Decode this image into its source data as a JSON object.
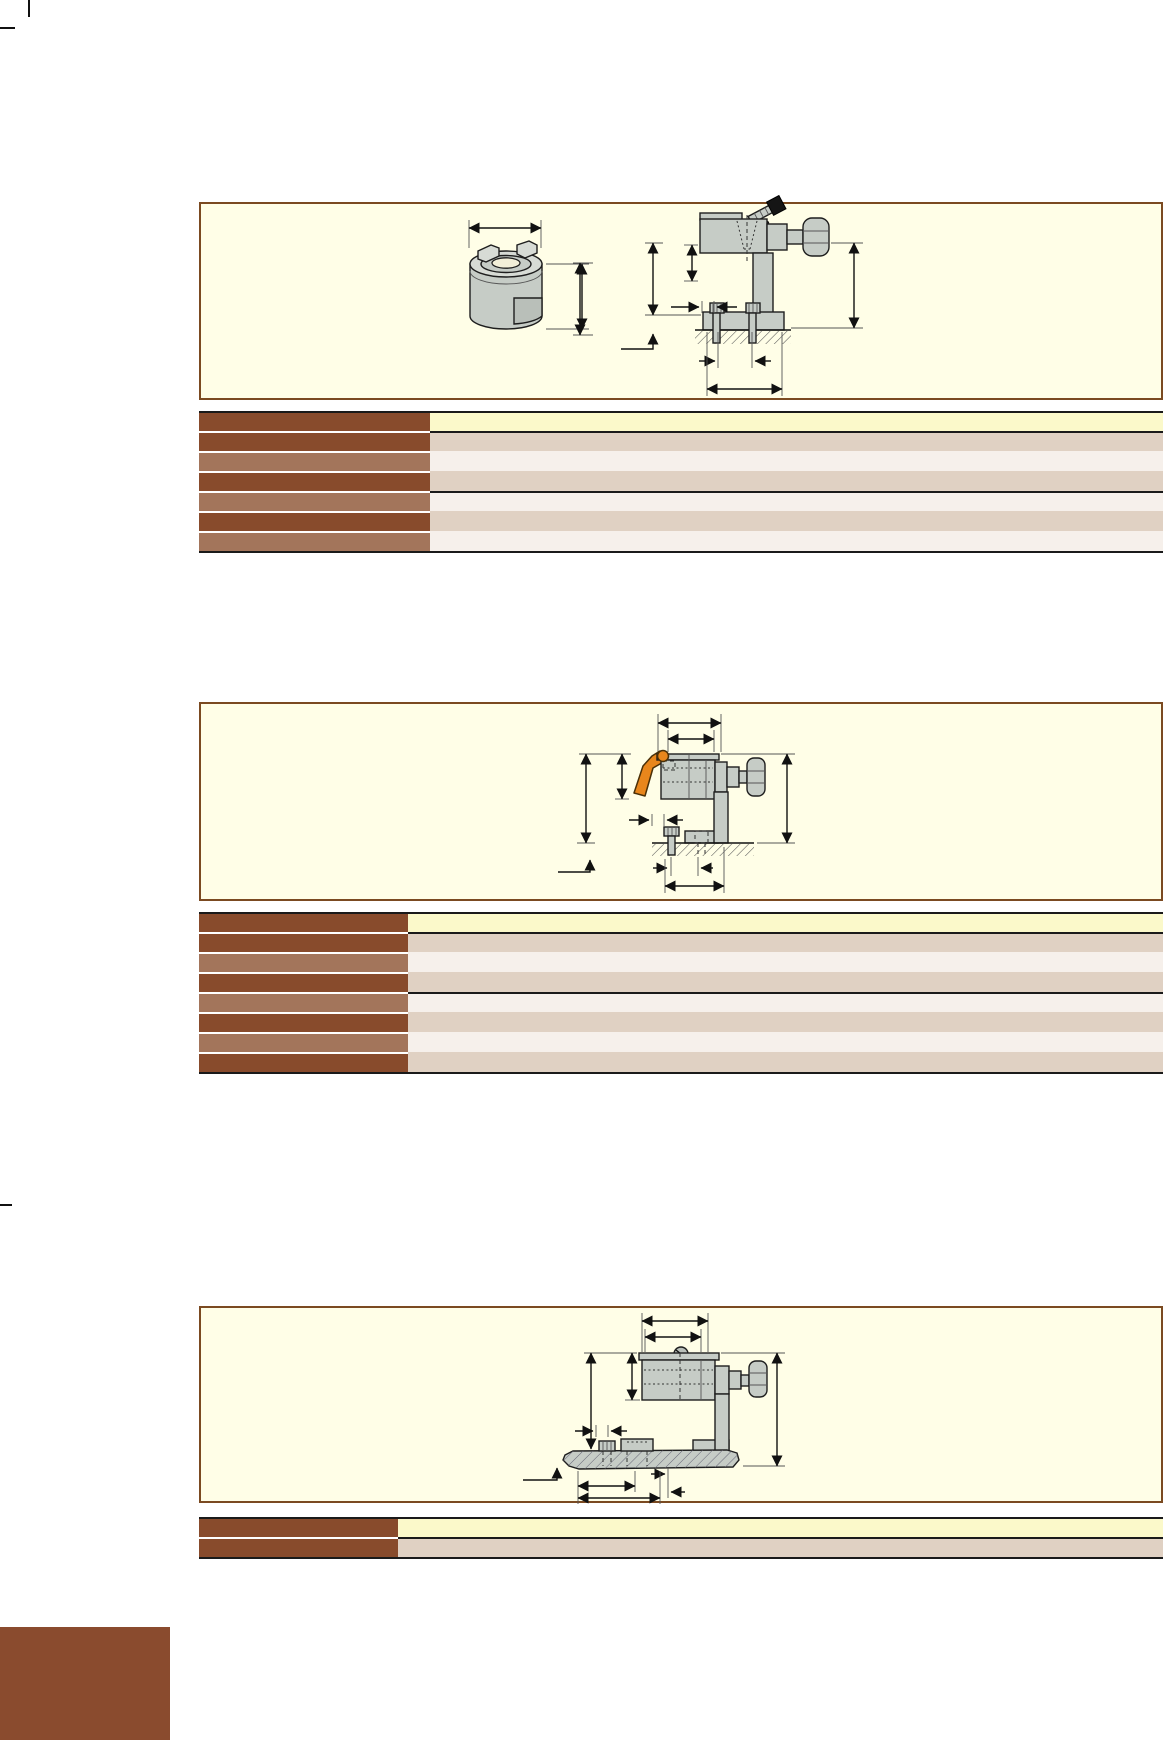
{
  "page": {
    "width": 1165,
    "height": 1740,
    "background": "#ffffff"
  },
  "colors": {
    "panel_fill": "#FFFEE7",
    "panel_border": "#7B4A21",
    "row_left_dark": "#884B2C",
    "row_left_medium": "#A3755B",
    "row_right_yellow": "#FBF9CA",
    "row_right_tan": "#E0D1C3",
    "row_right_light": "#F6F0EB",
    "table_line": "#1a1a1a",
    "accent_orange": "#E8861C",
    "part_gray": "#C6CCC6",
    "part_gray_light": "#D7DBD5",
    "part_gray_dark": "#B9BFB9",
    "footer_block_brown": "#8A4B2E"
  },
  "crop_marks": [
    {
      "x": 28,
      "y": 0,
      "w": 2,
      "h": 17
    },
    {
      "x": 0,
      "y": 27,
      "w": 15,
      "h": 2
    },
    {
      "x": 0,
      "y": 1204,
      "w": 12,
      "h": 2
    },
    {
      "x": 0,
      "y": 1711,
      "w": 15,
      "h": 2
    },
    {
      "x": 27,
      "y": 1721,
      "w": 2,
      "h": 19
    }
  ],
  "sections": [
    {
      "name": "product-block-1",
      "drawings": [
        "drive-dog-isometric-drawing",
        "clamp-stop-side-view-drawing"
      ],
      "table": {
        "left": 199,
        "top": 411,
        "width": 964,
        "header_col_width": 231,
        "rows": [
          {
            "kind": "header",
            "left_shade": "dark",
            "right_shade": "yellow",
            "separator_after": "black"
          },
          {
            "kind": "data",
            "left_shade": "dark",
            "right_shade": "tan",
            "separator_after": "none"
          },
          {
            "kind": "data",
            "left_shade": "medium",
            "right_shade": "light",
            "separator_after": "none"
          },
          {
            "kind": "data",
            "left_shade": "dark",
            "right_shade": "tan",
            "separator_after": "black"
          },
          {
            "kind": "data",
            "left_shade": "medium",
            "right_shade": "light",
            "separator_after": "none"
          },
          {
            "kind": "data",
            "left_shade": "dark",
            "right_shade": "tan",
            "separator_after": "none"
          },
          {
            "kind": "data",
            "left_shade": "medium",
            "right_shade": "light",
            "separator_after": "none"
          }
        ]
      }
    },
    {
      "name": "product-block-2",
      "drawings": [
        "lever-clamp-side-view-drawing"
      ],
      "table": {
        "left": 199,
        "top": 912,
        "width": 964,
        "header_col_width": 209,
        "rows": [
          {
            "kind": "header",
            "left_shade": "dark",
            "right_shade": "yellow",
            "separator_after": "black"
          },
          {
            "kind": "data",
            "left_shade": "dark",
            "right_shade": "tan",
            "separator_after": "none"
          },
          {
            "kind": "data",
            "left_shade": "medium",
            "right_shade": "light",
            "separator_after": "none"
          },
          {
            "kind": "data",
            "left_shade": "dark",
            "right_shade": "tan",
            "separator_after": "black"
          },
          {
            "kind": "data",
            "left_shade": "medium",
            "right_shade": "light",
            "separator_after": "none"
          },
          {
            "kind": "data",
            "left_shade": "dark",
            "right_shade": "tan",
            "separator_after": "none"
          },
          {
            "kind": "data",
            "left_shade": "medium",
            "right_shade": "light",
            "separator_after": "none"
          },
          {
            "kind": "data",
            "left_shade": "dark",
            "right_shade": "tan",
            "separator_after": "none"
          }
        ]
      }
    },
    {
      "name": "product-block-3",
      "drawings": [
        "plate-clamp-side-view-drawing"
      ],
      "table": {
        "left": 199,
        "top": 1517,
        "width": 964,
        "header_col_width": 199,
        "rows": [
          {
            "kind": "header",
            "left_shade": "dark",
            "right_shade": "yellow",
            "separator_after": "black"
          },
          {
            "kind": "data",
            "left_shade": "dark",
            "right_shade": "tan",
            "separator_after": "none"
          }
        ]
      }
    }
  ],
  "footer_block": {
    "left": 0,
    "top": 1627,
    "width": 170,
    "height": 113
  }
}
